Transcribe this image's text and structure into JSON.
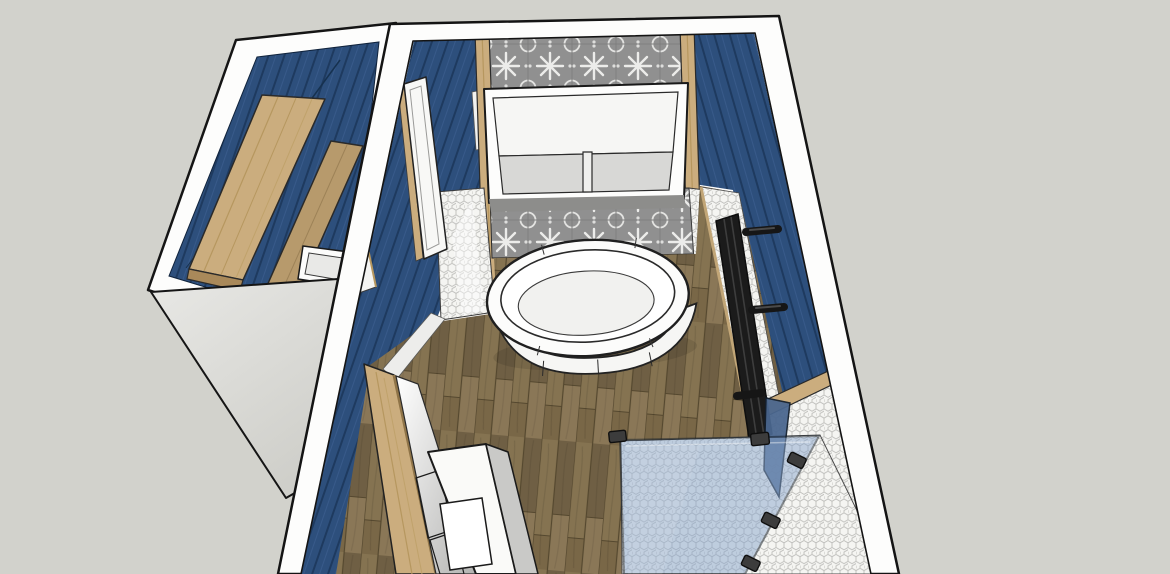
{
  "app": {
    "type": "3d-model-viewport",
    "description": "SketchUp-style top-down 3D render of a bathroom floor plan with adjoining closet"
  },
  "palette": {
    "background": "#d2d2cc",
    "wall_white": "#fdfdfc",
    "outline": "#161616",
    "blue_base": "#2d4f7c",
    "blue_line": "#1e3a5f",
    "blue_hilite": "#44689a",
    "wood_light": "#cbad7e",
    "wood_mid": "#b79a6c",
    "wood_edge": "#8f7448",
    "floor_a": "#857351",
    "floor_b": "#6f5f44",
    "floor_c": "#8a7757",
    "floor_joint": "#55482f",
    "tile_gray": "#909090",
    "tile_motif": "#ececea",
    "hex_fill": "#f5f5f2",
    "hex_line": "#bdbdba",
    "fixture_white": "#fcfcfb",
    "recess_gray": "#d8d8d6",
    "glass_blue": "#89a6cc",
    "glass_dark": "#4a678f",
    "radiator_dark": "#1b1b1b",
    "exterior_light": "#e8e8e5",
    "exterior_dark": "#cfcfca"
  },
  "scene": {
    "bathroom": {
      "walls": [
        "blue-shiplap-left-wall",
        "blue-shiplap-right-wall",
        "patterned-tile-feature-wall",
        "hex-tile-wainscot"
      ],
      "fixtures": [
        "freestanding-oval-bathtub",
        "wall-hung-vanity-cabinet",
        "towel-radiator",
        "glass-shower-screen",
        "under-counter-cabinet-with-sink",
        "wood-counter",
        "white-door"
      ],
      "floor": "oak-plank-floor",
      "shower_floor": "hex-mosaic-tile"
    },
    "closet": {
      "walls": [
        "blue-shiplap-walls"
      ],
      "fixtures": [
        "upper-wood-shelf",
        "lower-wood-shelf",
        "small-white-sink"
      ],
      "exterior": "gray-plaster-gable-face"
    }
  }
}
